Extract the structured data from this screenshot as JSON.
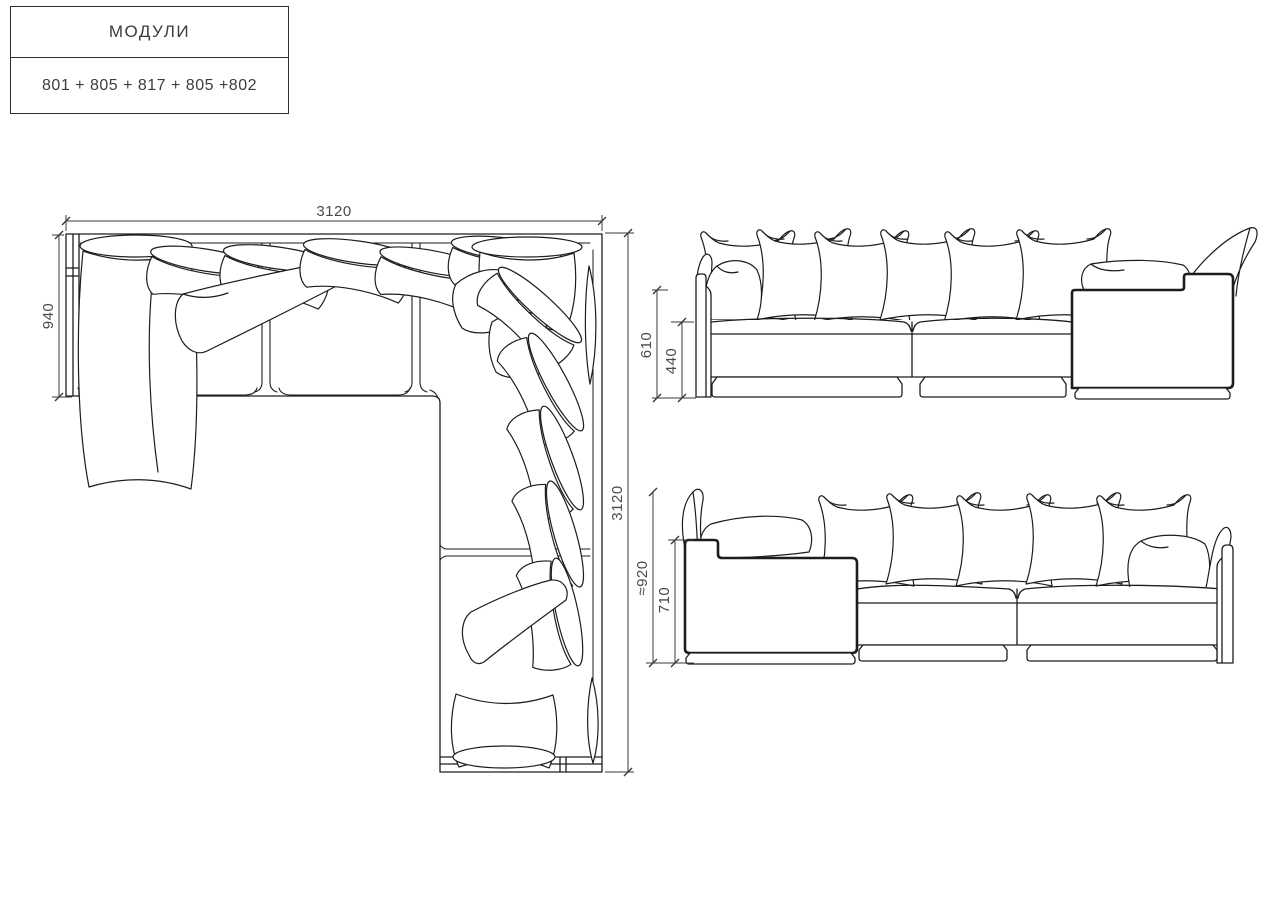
{
  "title_block": {
    "title": "МОДУЛИ",
    "modules_formula": "801 + 805 + 817 + 805 +802"
  },
  "views": {
    "plan": {
      "dims": {
        "width_top": "3120",
        "depth_left": "940",
        "length_right": "3120"
      }
    },
    "front_elevation": {
      "dims": {
        "back_height": "610",
        "seat_height": "440"
      }
    },
    "side_elevation": {
      "dims": {
        "overall_height": "≈920",
        "back_height": "710"
      }
    }
  }
}
